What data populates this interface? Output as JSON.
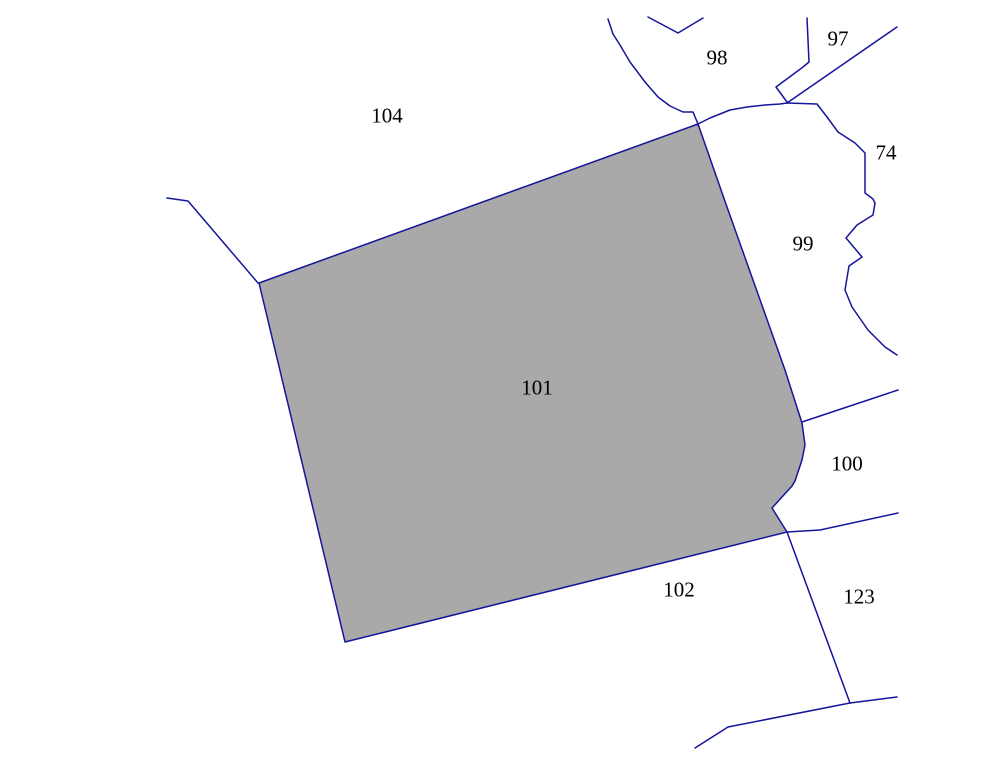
{
  "map": {
    "width": 1006,
    "height": 776,
    "background_color": "#ffffff",
    "boundary_line_color": "#15159b",
    "boundary_line_width": 1.5,
    "selected_parcel_fill": "#a9a9a9",
    "label_color": "#000000",
    "label_font_size": 21,
    "selected_parcel": {
      "id": "101",
      "name": "parcel-101-selected",
      "points": [
        [
          698,
          124
        ],
        [
          727,
          207
        ],
        [
          785,
          370
        ],
        [
          793,
          395
        ],
        [
          802,
          423
        ],
        [
          805,
          445
        ],
        [
          802,
          460
        ],
        [
          795,
          481
        ],
        [
          792,
          486
        ],
        [
          772,
          508
        ],
        [
          787,
          532
        ],
        [
          345,
          642
        ],
        [
          259,
          283
        ]
      ]
    },
    "boundaries": [
      {
        "name": "boundary-west-fragment",
        "points": [
          [
            167,
            198
          ],
          [
            188,
            201
          ],
          [
            258,
            283
          ]
        ]
      },
      {
        "name": "boundary-98-west",
        "points": [
          [
            608,
            19
          ],
          [
            613,
            34
          ],
          [
            620,
            45
          ],
          [
            630,
            62
          ],
          [
            645,
            82
          ],
          [
            658,
            97
          ],
          [
            670,
            106
          ],
          [
            683,
            112
          ],
          [
            693,
            112
          ],
          [
            698,
            124
          ]
        ]
      },
      {
        "name": "boundary-98-south",
        "points": [
          [
            698,
            124
          ],
          [
            710,
            118
          ],
          [
            730,
            110
          ],
          [
            747,
            107
          ],
          [
            765,
            105
          ],
          [
            780,
            104
          ],
          [
            787,
            103
          ]
        ]
      },
      {
        "name": "boundary-98-north-notch",
        "points": [
          [
            648,
            17
          ],
          [
            678,
            33
          ],
          [
            703,
            18
          ]
        ]
      },
      {
        "name": "boundary-97-west",
        "points": [
          [
            807,
            18
          ],
          [
            809,
            62
          ],
          [
            803,
            67
          ],
          [
            776,
            87
          ],
          [
            787,
            102
          ]
        ]
      },
      {
        "name": "boundary-97-south-diagonal",
        "points": [
          [
            897,
            27
          ],
          [
            787,
            103
          ]
        ]
      },
      {
        "name": "boundary-74-west",
        "points": [
          [
            787,
            103
          ],
          [
            817,
            104
          ],
          [
            827,
            117
          ],
          [
            838,
            132
          ],
          [
            855,
            143
          ],
          [
            865,
            153
          ],
          [
            865,
            193
          ],
          [
            873,
            199
          ],
          [
            875,
            203
          ],
          [
            873,
            215
          ],
          [
            857,
            225
          ],
          [
            846,
            238
          ],
          [
            862,
            257
          ],
          [
            849,
            266
          ],
          [
            845,
            290
          ],
          [
            852,
            307
          ],
          [
            868,
            330
          ],
          [
            885,
            347
          ],
          [
            897,
            355
          ]
        ]
      },
      {
        "name": "boundary-99-100",
        "points": [
          [
            802,
            422
          ],
          [
            898,
            390
          ]
        ]
      },
      {
        "name": "boundary-100-123",
        "points": [
          [
            787,
            532
          ],
          [
            820,
            530
          ],
          [
            898,
            513
          ]
        ]
      },
      {
        "name": "boundary-123-west",
        "points": [
          [
            787,
            532
          ],
          [
            850,
            703
          ]
        ]
      },
      {
        "name": "boundary-south",
        "points": [
          [
            695,
            748
          ],
          [
            728,
            727
          ],
          [
            850,
            703
          ],
          [
            897,
            697
          ]
        ]
      }
    ],
    "labels": [
      {
        "text": "104",
        "x": 387,
        "y": 115,
        "name": "parcel-label-104"
      },
      {
        "text": "98",
        "x": 717,
        "y": 57,
        "name": "parcel-label-98"
      },
      {
        "text": "97",
        "x": 838,
        "y": 38,
        "name": "parcel-label-97"
      },
      {
        "text": "74",
        "x": 886,
        "y": 152,
        "name": "parcel-label-74"
      },
      {
        "text": "99",
        "x": 803,
        "y": 243,
        "name": "parcel-label-99"
      },
      {
        "text": "101",
        "x": 537,
        "y": 387,
        "name": "parcel-label-101"
      },
      {
        "text": "100",
        "x": 847,
        "y": 463,
        "name": "parcel-label-100"
      },
      {
        "text": "102",
        "x": 679,
        "y": 589,
        "name": "parcel-label-102"
      },
      {
        "text": "123",
        "x": 859,
        "y": 596,
        "name": "parcel-label-123"
      }
    ]
  }
}
